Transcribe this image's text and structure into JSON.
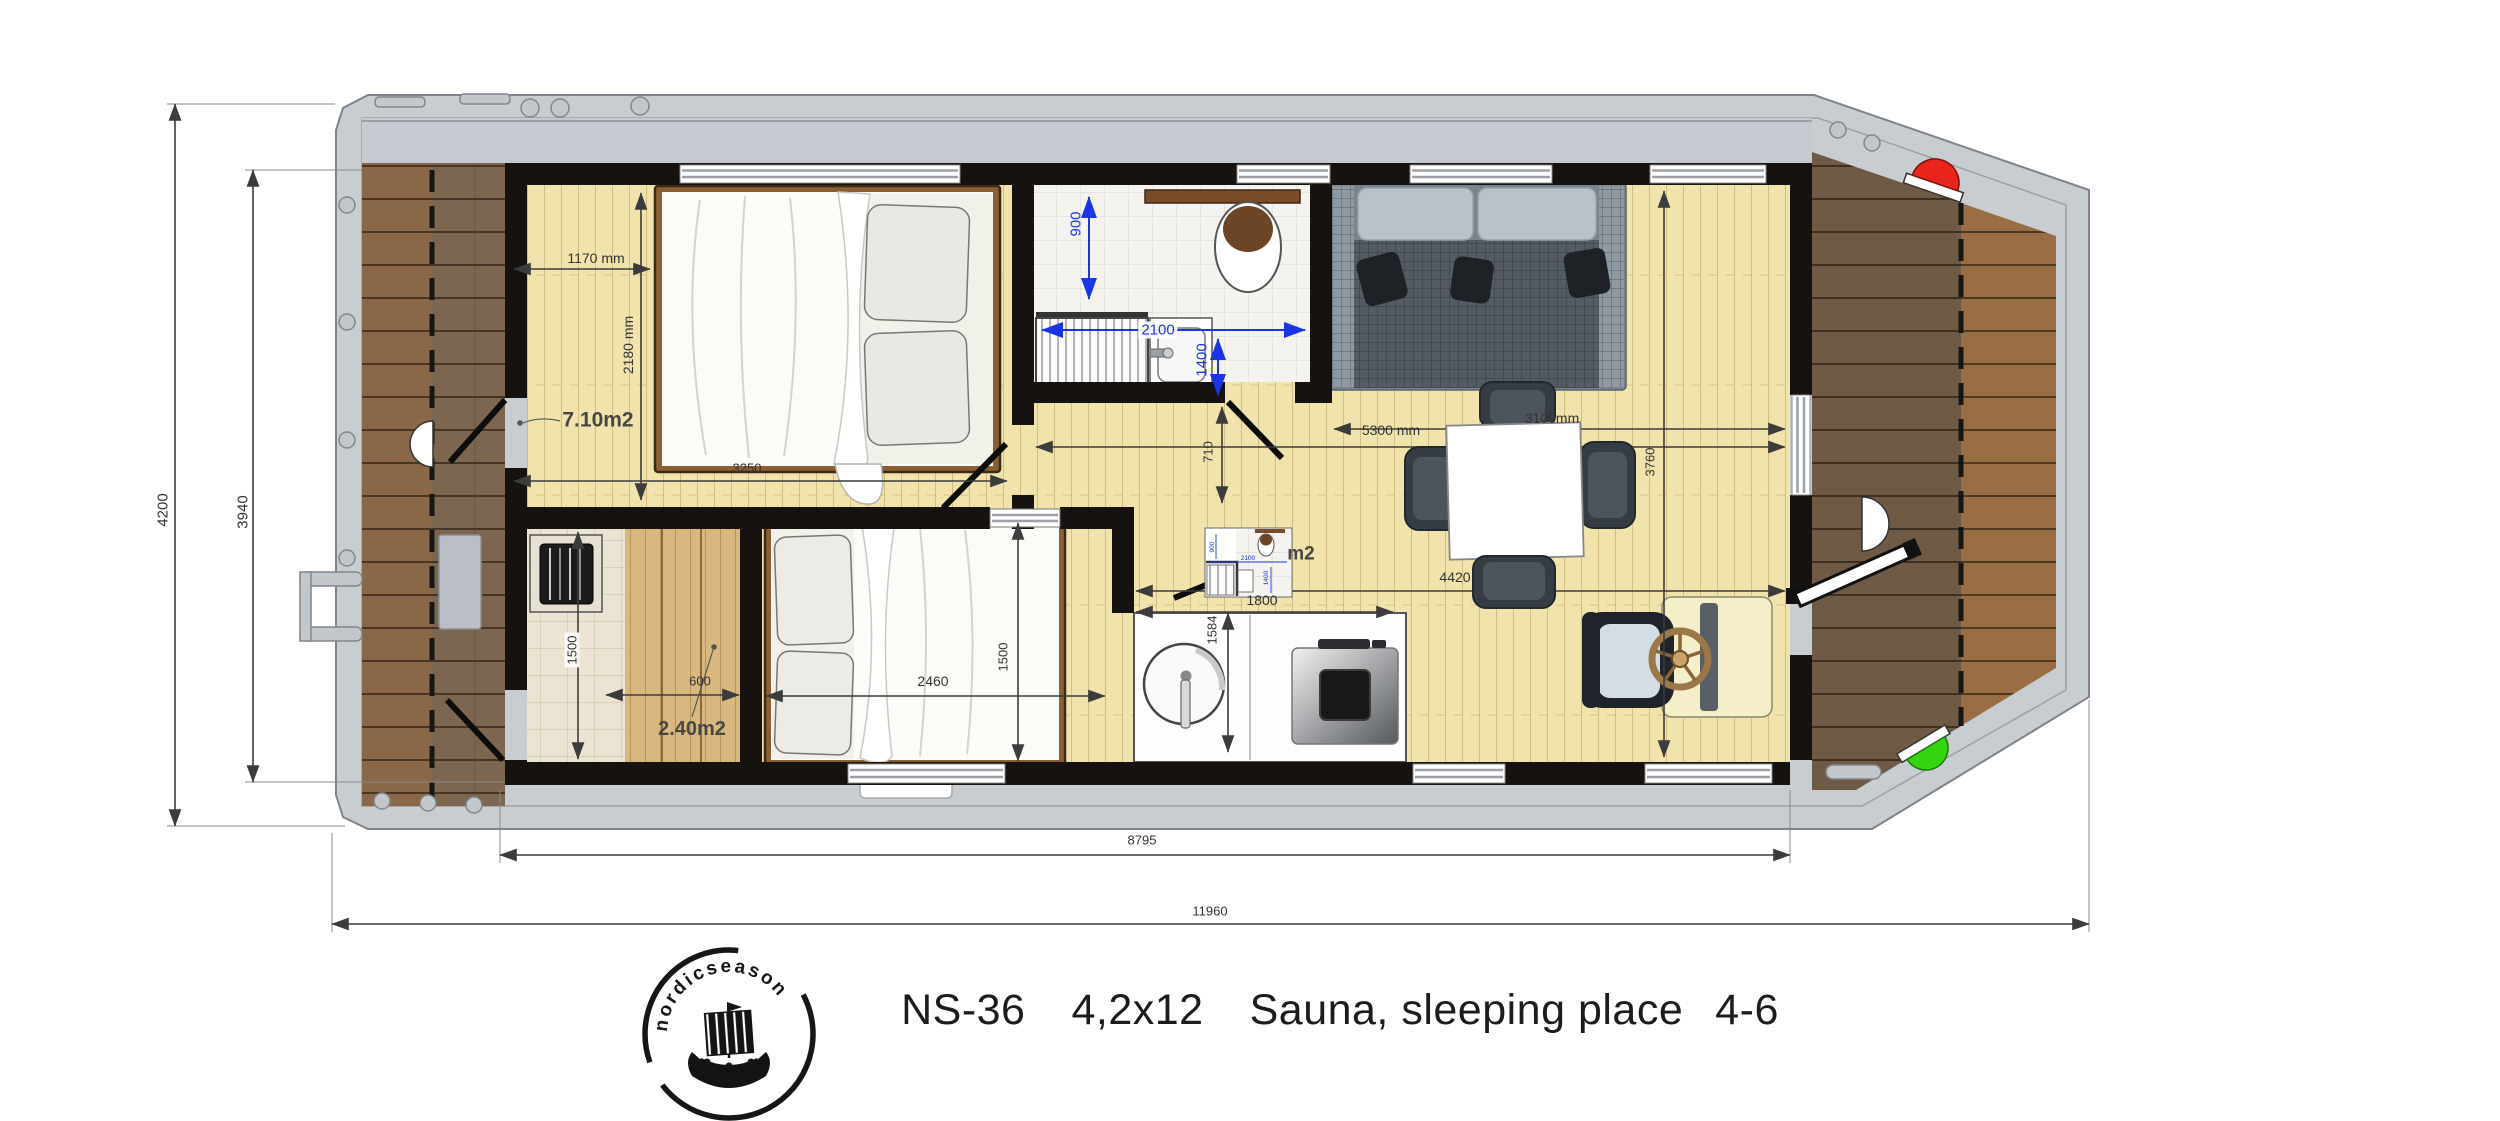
{
  "title": {
    "model": "NS-36",
    "size": "4,2x12",
    "sleeping": "Sauna, sleeping place",
    "capacity": "4-6"
  },
  "logo": {
    "brand": "nordicseason"
  },
  "boat": {
    "overall_length": "11960",
    "cabin_length": "8795",
    "overall_beam": "4200",
    "inner_beam": "3940"
  },
  "bedroom1": {
    "area": "7.10m2",
    "width": "1170 mm",
    "depth": "2180 mm",
    "length": "3250"
  },
  "bathroom": {
    "width": "900",
    "length": "2100",
    "depth": "1400",
    "area_suffix": "m2",
    "inset": {
      "width": "900",
      "length": "2100",
      "depth": "1400"
    }
  },
  "hallway": {
    "width": "710"
  },
  "living": {
    "sofa_wall": "3100mm",
    "length": "5300 mm",
    "width": "3760",
    "dining_width": "4420"
  },
  "kitchen": {
    "counter_length": "1800",
    "counter_depth": "1584"
  },
  "sauna": {
    "area": "2.40m2",
    "depth": "1500",
    "bench_width": "600"
  },
  "bedroom2": {
    "bed_length": "2460",
    "bed_width": "1500"
  }
}
